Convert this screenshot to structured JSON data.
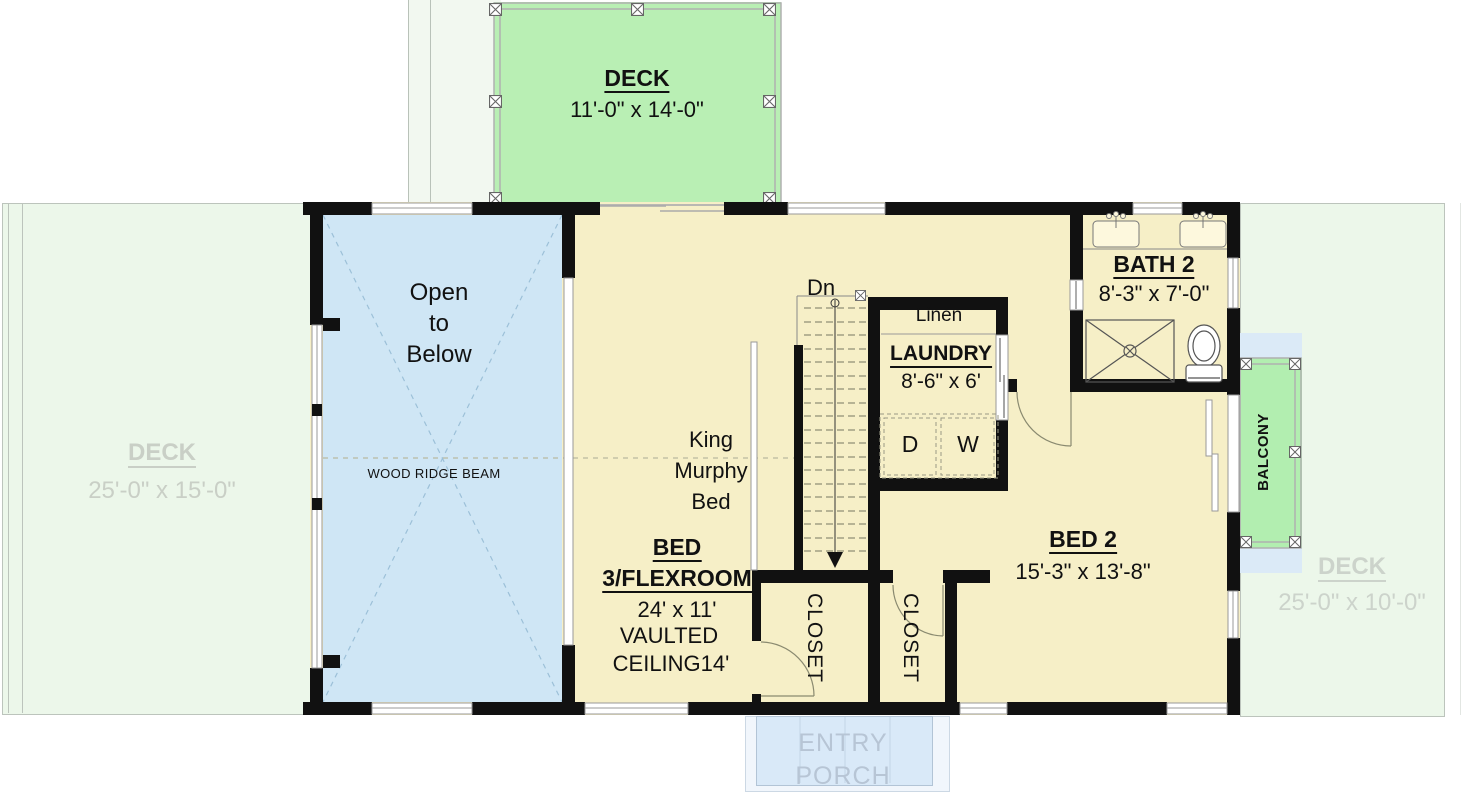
{
  "plan": {
    "top_deck": {
      "name": "DECK",
      "dims": "11'-0\" x 14'-0\""
    },
    "left_deck": {
      "name": "DECK",
      "dims": "25'-0\" x 15'-0\""
    },
    "right_deck": {
      "name": "DECK",
      "dims": "25'-0\" x 10'-0\""
    },
    "open_to_below": {
      "line1": "Open",
      "line2": "to",
      "line3": "Below",
      "beam_label": "WOOD RIDGE BEAM"
    },
    "bed3": {
      "title1": "BED",
      "title2": "3/FLEXROOM",
      "dims": "24' x 11'",
      "note1": "VAULTED",
      "note2": "CEILING14'",
      "murphy1": "King",
      "murphy2": "Murphy",
      "murphy3": "Bed"
    },
    "stairs": {
      "down_label": "Dn"
    },
    "laundry": {
      "title": "LAUNDRY",
      "dims": "8'-6\" x 6'",
      "linen": "Linen",
      "dryer": "D",
      "washer": "W"
    },
    "bath2": {
      "title": "BATH 2",
      "dims": "8'-3\" x 7'-0\""
    },
    "bed2": {
      "title": "BED 2",
      "dims": "15'-3\" x 13'-8\""
    },
    "closet_left": {
      "label": "CLOSET"
    },
    "closet_right": {
      "label": "CLOSET"
    },
    "balcony": {
      "label": "BALCONY"
    },
    "entry_porch": {
      "line1": "ENTRY",
      "line2": "PORCH"
    }
  },
  "colors": {
    "deck_green": "#b9efb4",
    "pale_deck": "#ecf7ea",
    "room_cream": "#f6efc7",
    "open_blue": "#cfe6f5",
    "porch_blue": "#d9e9f8",
    "wall_black": "#111111",
    "faded_deck_text": "#c9cfc6",
    "porch_text": "#b7c5d5"
  }
}
